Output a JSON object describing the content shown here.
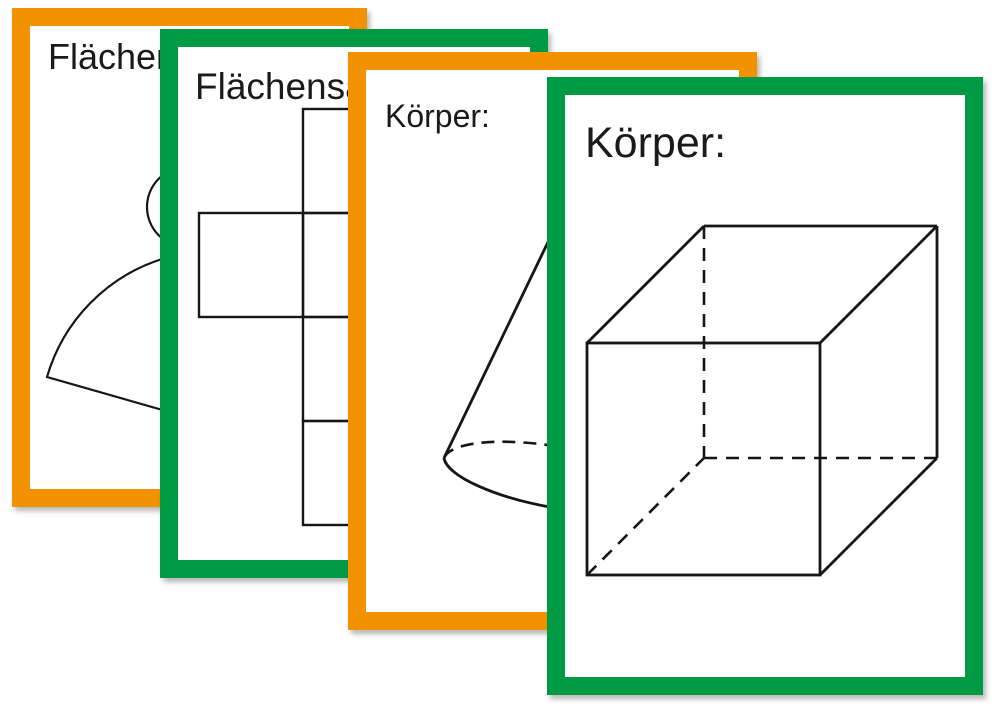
{
  "colors": {
    "orange": "#F29200",
    "green": "#009A44",
    "ink": "#1A1A1A",
    "background": "#FFFFFF"
  },
  "cards": [
    {
      "title": "Flächensatz:",
      "border_color": "#F29200",
      "frame": "orange",
      "drawing": "cone-net"
    },
    {
      "title": "Flächensatz:",
      "border_color": "#009A44",
      "frame": "green",
      "drawing": "cube-net"
    },
    {
      "title": "Körper:",
      "border_color": "#F29200",
      "frame": "orange",
      "drawing": "cone"
    },
    {
      "title": "Körper:",
      "border_color": "#009A44",
      "frame": "green",
      "drawing": "cube"
    }
  ]
}
